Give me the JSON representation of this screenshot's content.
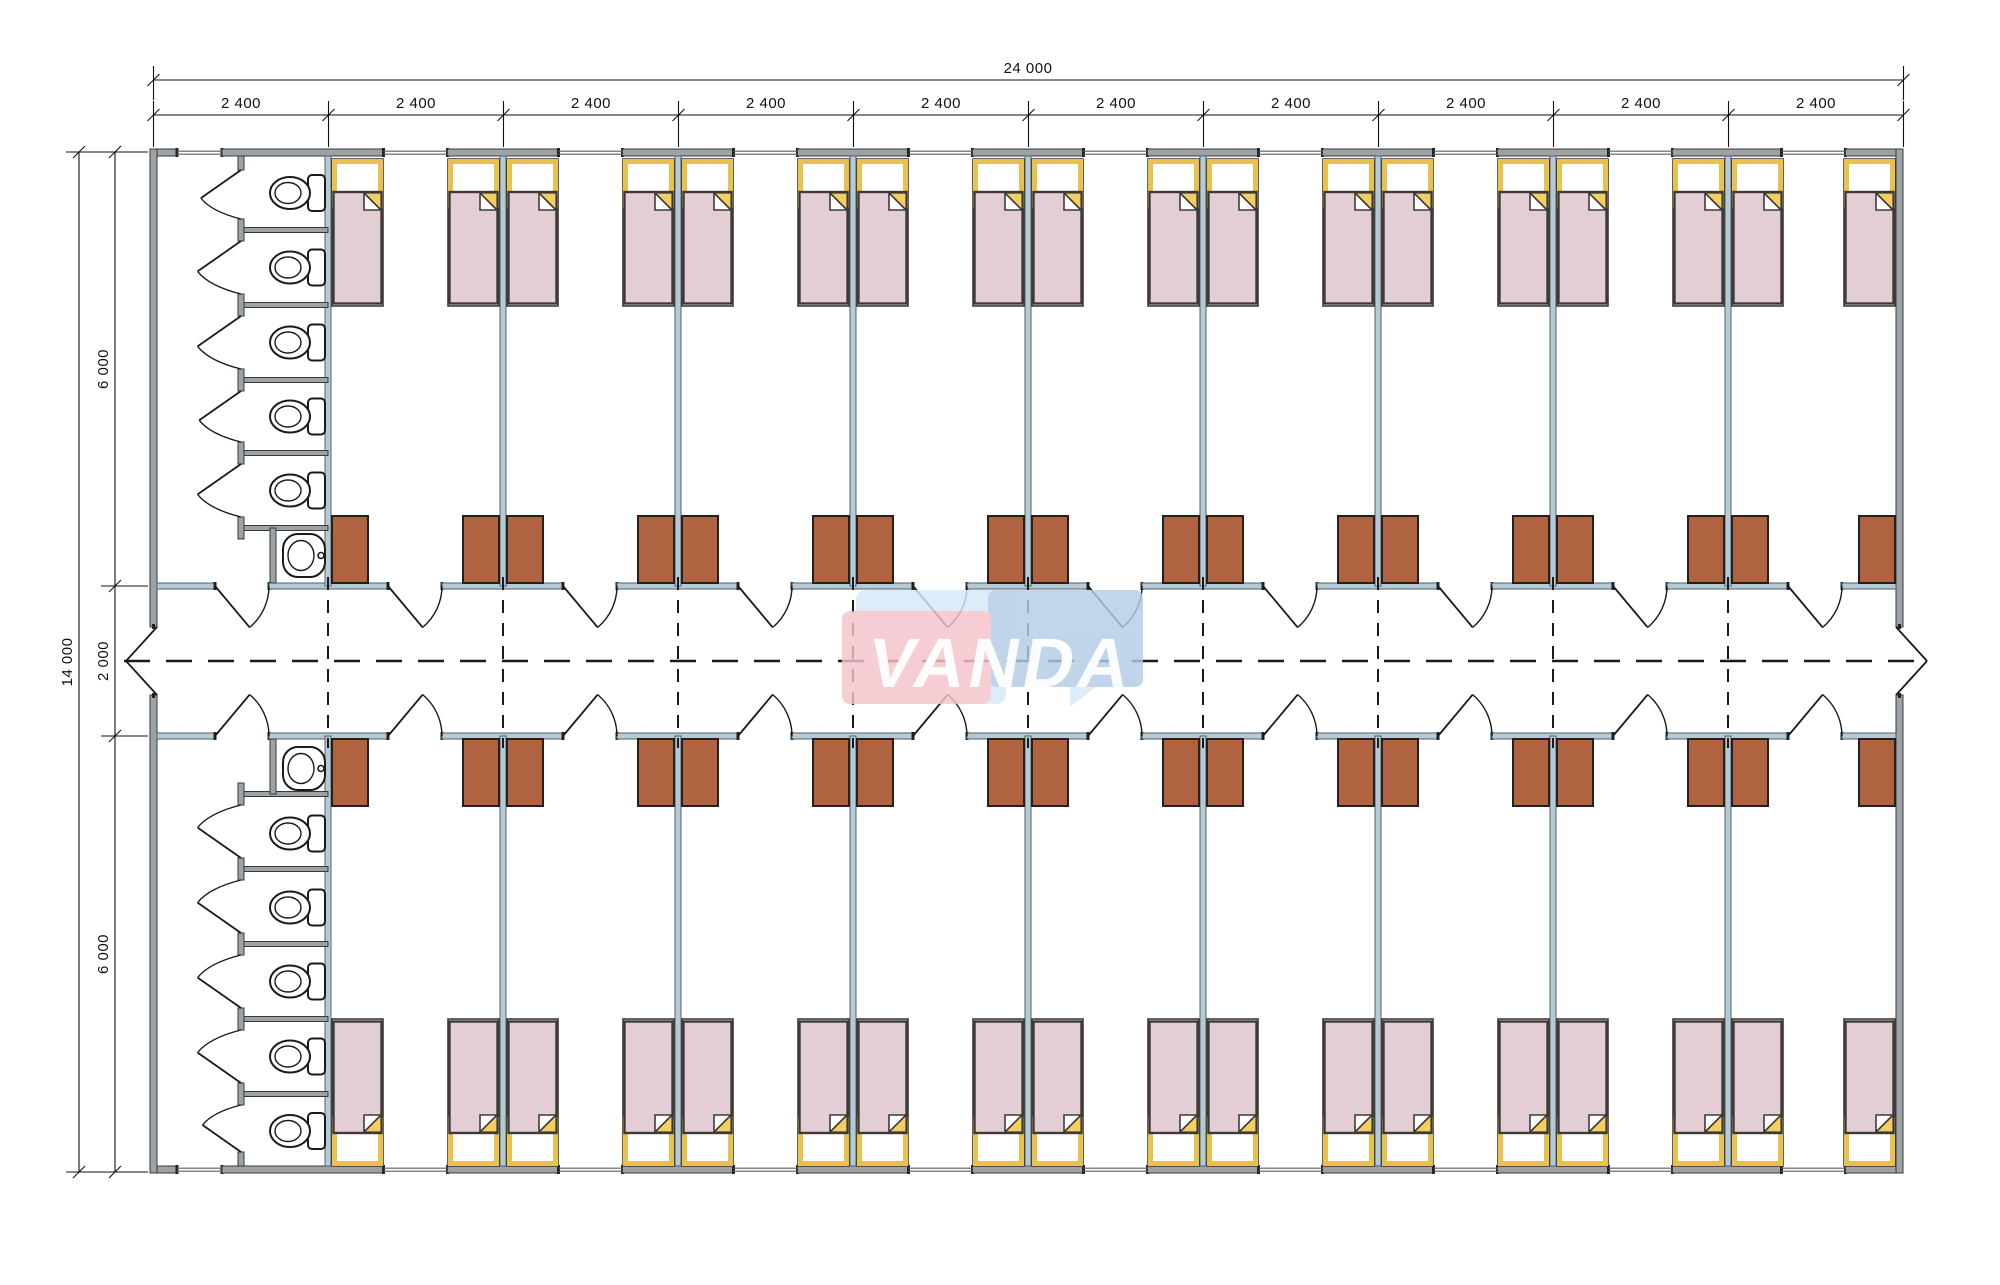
{
  "watermark": {
    "text": "VANDA"
  },
  "dimensions": {
    "top_total": "24 000",
    "top_bays": [
      "2 400",
      "2 400",
      "2 400",
      "2 400",
      "2 400",
      "2 400",
      "2 400",
      "2 400",
      "2 400",
      "2 400"
    ],
    "left_total": "14 000",
    "left_segments": [
      "6 000",
      "2 000",
      "6 000"
    ]
  },
  "structure": {
    "bays": 10,
    "bay_width_mm": 2400,
    "total_width_mm": 24000,
    "total_depth_mm": 14000,
    "wing_depth_mm": 6000,
    "corridor_depth_mm": 2000,
    "rooms_per_wing": 9,
    "beds_per_room": 2,
    "wardrobes_per_room": 2,
    "windows_per_room": 1,
    "toilet_blocks": 2,
    "toilet_stalls_per_block": 5,
    "sinks_per_block": 1,
    "corridor_entrances": 2
  },
  "colors": {
    "exterior_wall": "#9ca2a6",
    "exterior_wall_stroke": "#35393c",
    "interior_wall": "#b5cad4",
    "interior_wall_stroke": "#51616a",
    "wall_cap": "#1f2326",
    "window_glaze": "#5a6064",
    "bed_mattress": "#e3ced6",
    "bed_yellow": "#e9c24d",
    "bed_fold_yellow": "#f3cf63",
    "bed_outline": "#3f3a35",
    "wardrobe": "#b06340",
    "wardrobe_stroke": "#24201d",
    "fixture_stroke": "#1a1a1a",
    "dash": "#1a1a1a",
    "dimension": "#111111",
    "watermark_pink": "#f6c3cb",
    "watermark_blue": "#b3cde6",
    "watermark_pale": "#d5e8f7",
    "watermark_text_color": "#ffffff"
  }
}
